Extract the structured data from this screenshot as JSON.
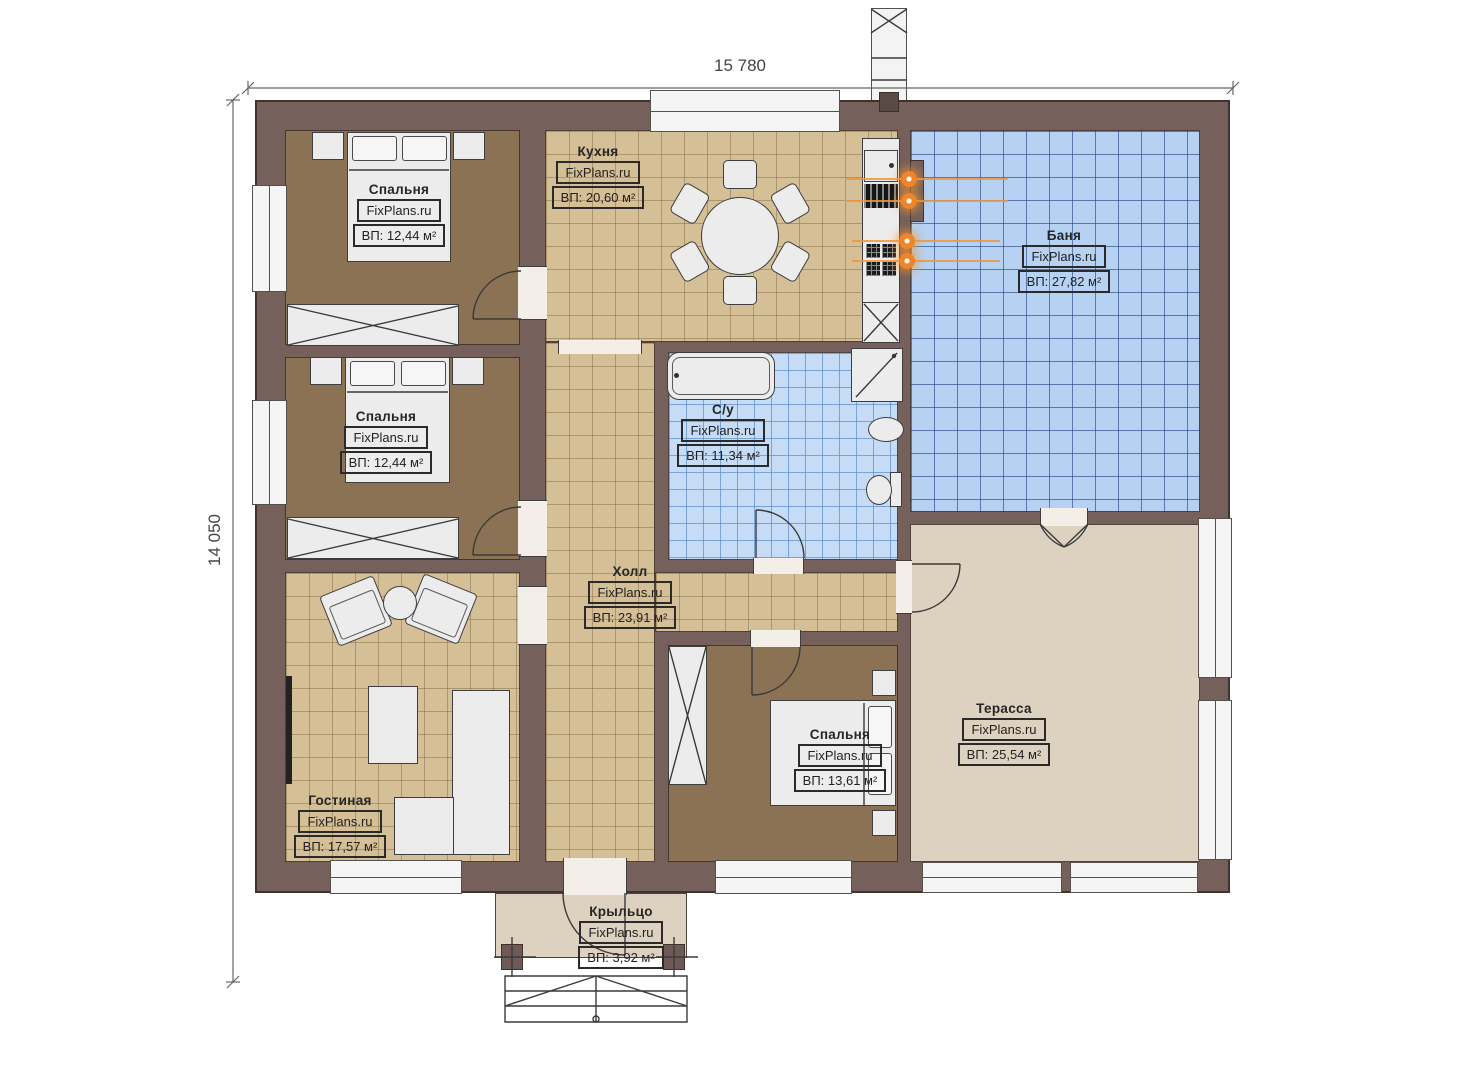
{
  "dimensions": {
    "top": "15 780",
    "left": "14 050"
  },
  "watermark": "FixPlans.ru",
  "rooms": {
    "bedroom1": {
      "name": "Спальня",
      "area": "ВП: 12,44 м²"
    },
    "kitchen": {
      "name": "Кухня",
      "area": "ВП: 20,60 м²"
    },
    "banya": {
      "name": "Баня",
      "area": "ВП: 27,82 м²"
    },
    "bedroom2": {
      "name": "Спальня",
      "area": "ВП: 12,44 м²"
    },
    "su": {
      "name": "С/у",
      "area": "ВП: 11,34 м²"
    },
    "hall": {
      "name": "Холл",
      "area": "ВП: 23,91 м²"
    },
    "living": {
      "name": "Гостиная",
      "area": "ВП: 17,57 м²"
    },
    "bedroom3": {
      "name": "Спальня",
      "area": "ВП: 13,61 м²"
    },
    "terrace": {
      "name": "Терасса",
      "area": "ВП: 25,54 м²"
    },
    "porch": {
      "name": "Крыльцо",
      "area": "ВП: 3,92 м²"
    }
  },
  "colors": {
    "wall": "#75605b",
    "bedroom_floor": "#8b7254",
    "tile_tan": "#d4bf96",
    "tile_banya": "#b6d1f1",
    "tile_su": "#c6dcf6",
    "terrace_floor": "#ddd2bf",
    "furniture": "#ececec",
    "accent_orange": "#ee7d1e"
  }
}
